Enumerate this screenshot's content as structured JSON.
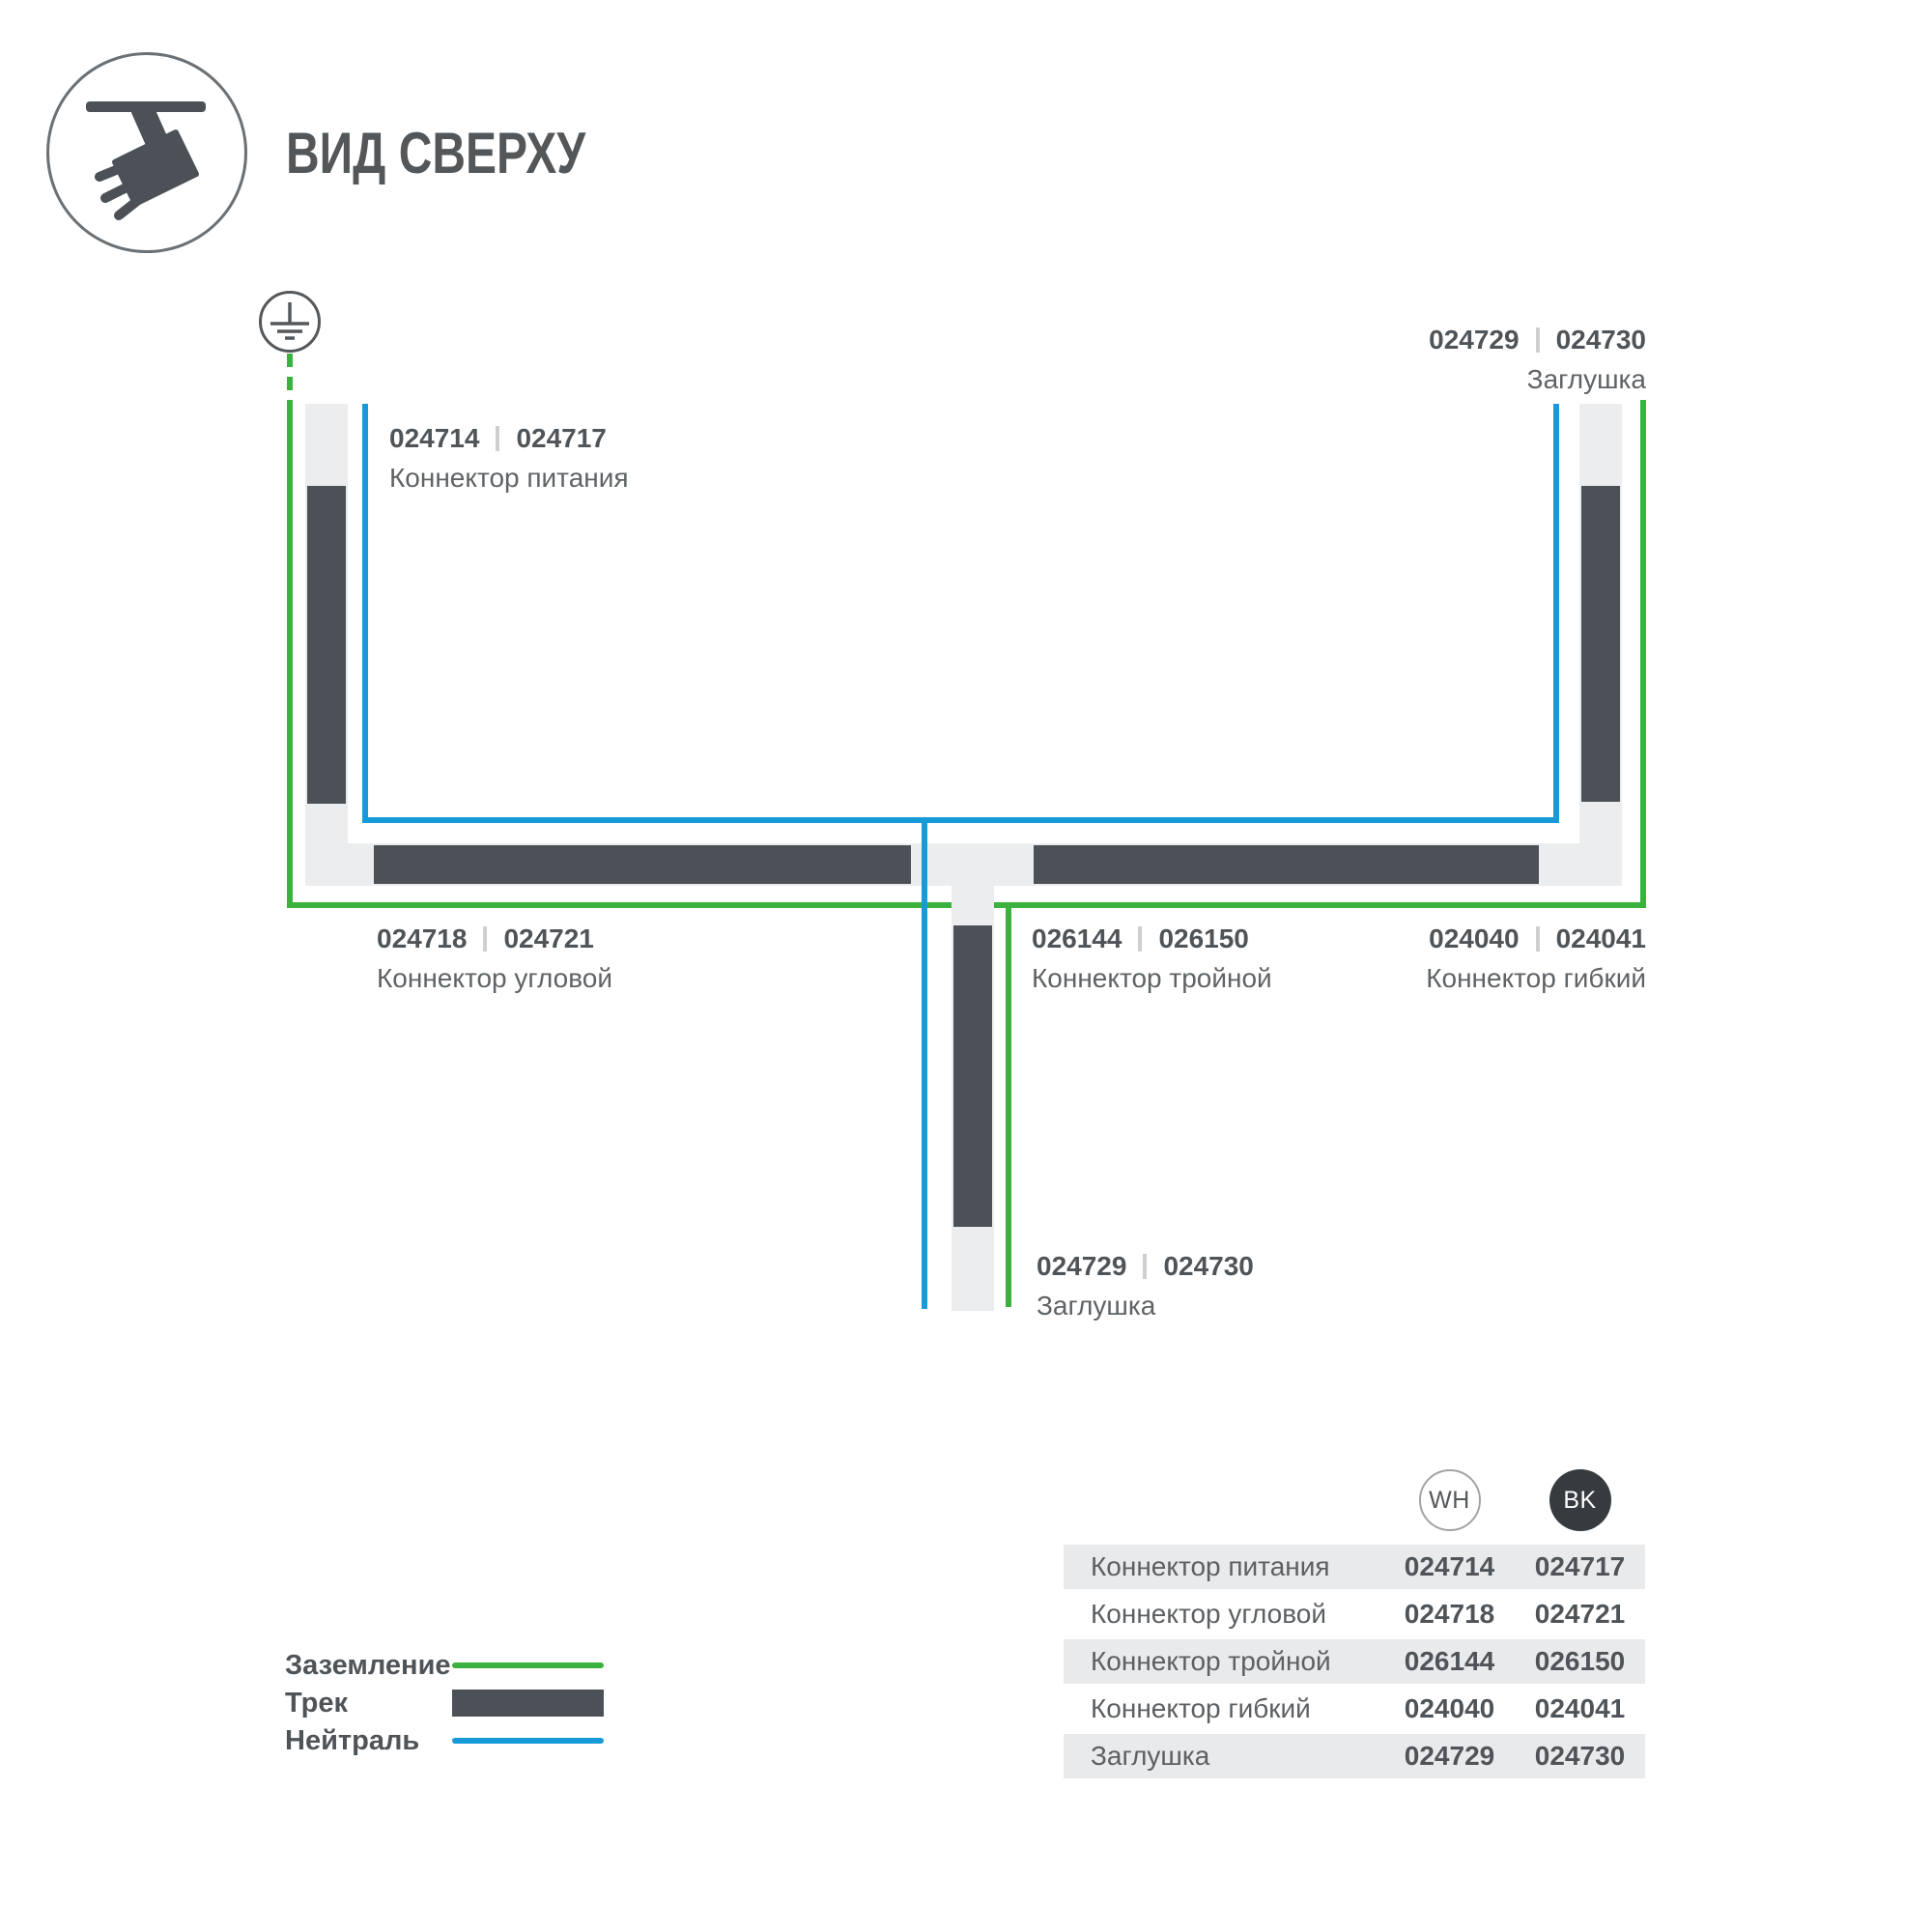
{
  "header": {
    "title": "ВИД СВЕРХУ"
  },
  "diagram": {
    "labels": [
      {
        "code_wh": "024714",
        "code_bk": "024717",
        "name": "Коннектор питания"
      },
      {
        "code_wh": "024729",
        "code_bk": "024730",
        "name": "Заглушка"
      },
      {
        "code_wh": "024718",
        "code_bk": "024721",
        "name": "Коннектор угловой"
      },
      {
        "code_wh": "026144",
        "code_bk": "026150",
        "name": "Коннектор тройной"
      },
      {
        "code_wh": "024040",
        "code_bk": "024041",
        "name": "Коннектор гибкий"
      },
      {
        "code_wh": "024729",
        "code_bk": "024730",
        "name": "Заглушка"
      }
    ]
  },
  "legend": {
    "ground_label": "Заземление",
    "track_label": "Трек",
    "neutral_label": "Нейтраль"
  },
  "table": {
    "col_wh": "WH",
    "col_bk": "BK",
    "rows": [
      {
        "name": "Коннектор питания",
        "wh": "024714",
        "bk": "024717"
      },
      {
        "name": "Коннектор угловой",
        "wh": "024718",
        "bk": "024721"
      },
      {
        "name": "Коннектор тройной",
        "wh": "026144",
        "bk": "026150"
      },
      {
        "name": "Коннектор гибкий",
        "wh": "024040",
        "bk": "024041"
      },
      {
        "name": "Заглушка",
        "wh": "024729",
        "bk": "024730"
      }
    ]
  },
  "colors": {
    "green": "#3cb23e",
    "blue": "#1899d8",
    "track_dark": "#4b5156",
    "track_light": "#ecedee"
  }
}
